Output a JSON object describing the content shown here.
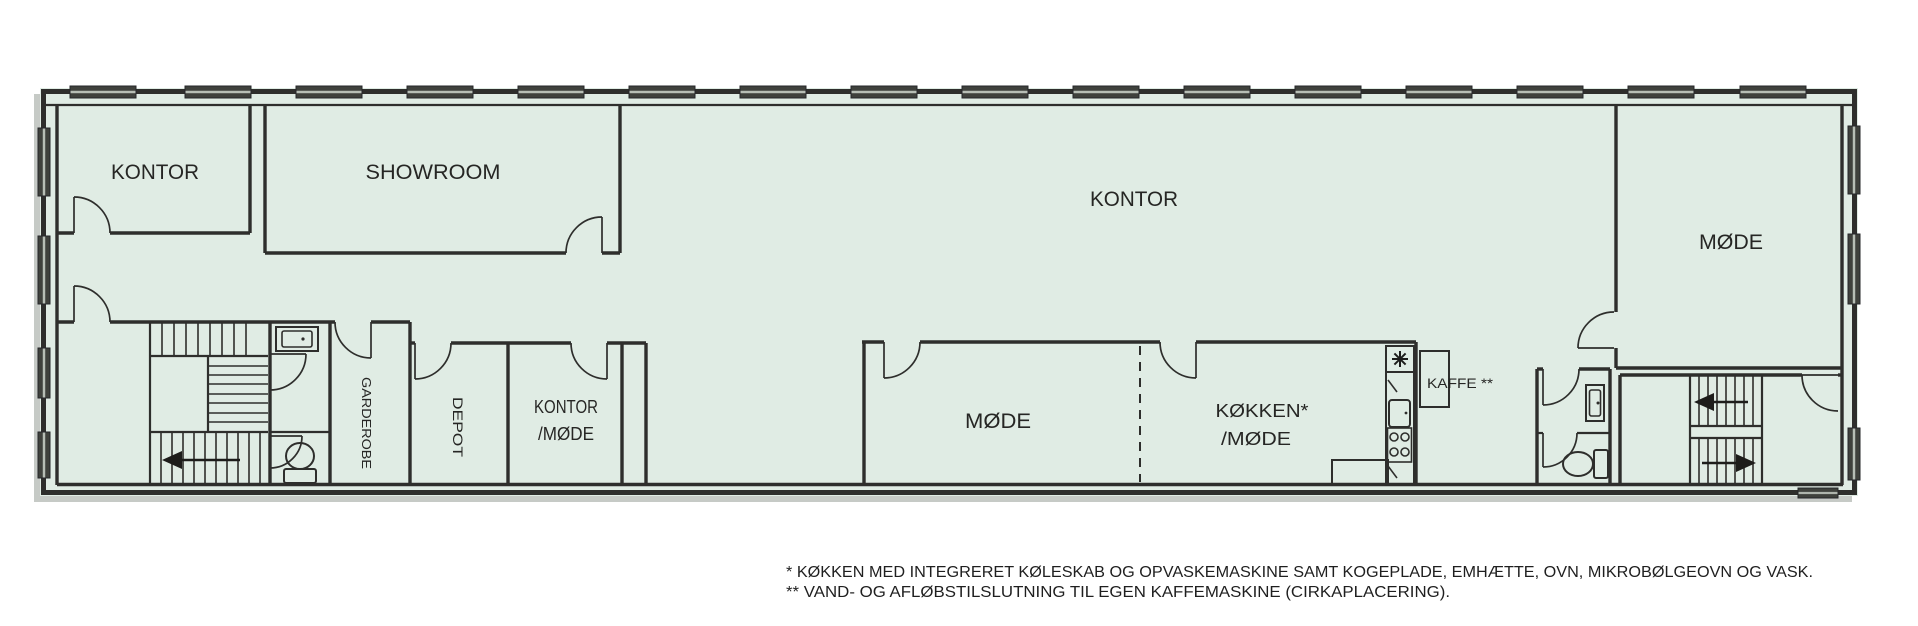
{
  "rooms": {
    "kontor_top_left": "KONTOR",
    "showroom": "SHOWROOM",
    "kontor_main": "KONTOR",
    "moede_right": "MØDE",
    "kontor_moede_line1": "KONTOR",
    "kontor_moede_line2": "/MØDE",
    "moede_mid": "MØDE",
    "koekken_line1": "KØKKEN*",
    "koekken_line2": "/MØDE",
    "garderobe": "GARDEROBE",
    "depot": "DEPOT",
    "kaffe": "KAFFE **"
  },
  "footnotes": {
    "line1": "* KØKKEN MED INTEGRERET KØLESKAB OG OPVASKEMASKINE SAMT KOGEPLADE, EMHÆTTE, OVN, MIKROBØLGEOVN OG VASK.",
    "line2": "** VAND- OG AFLØBSTILSLUTNING TIL EGEN KAFFEMASKINE (CIRKAPLACERING)."
  },
  "colors": {
    "floor": "#e0ece4",
    "wall": "#2e2e2c",
    "counter": "#d5e3d9",
    "window_glass": "#3f413c",
    "shadow": "#c6cac6",
    "background": "#ffffff",
    "text": "#262624"
  },
  "icons": {
    "cooktop_star": "8-spoke-asterisk",
    "stair_arrows": "direction-arrows",
    "toilet": "toilet-plan-symbol",
    "sink": "sink-plan-symbol"
  }
}
